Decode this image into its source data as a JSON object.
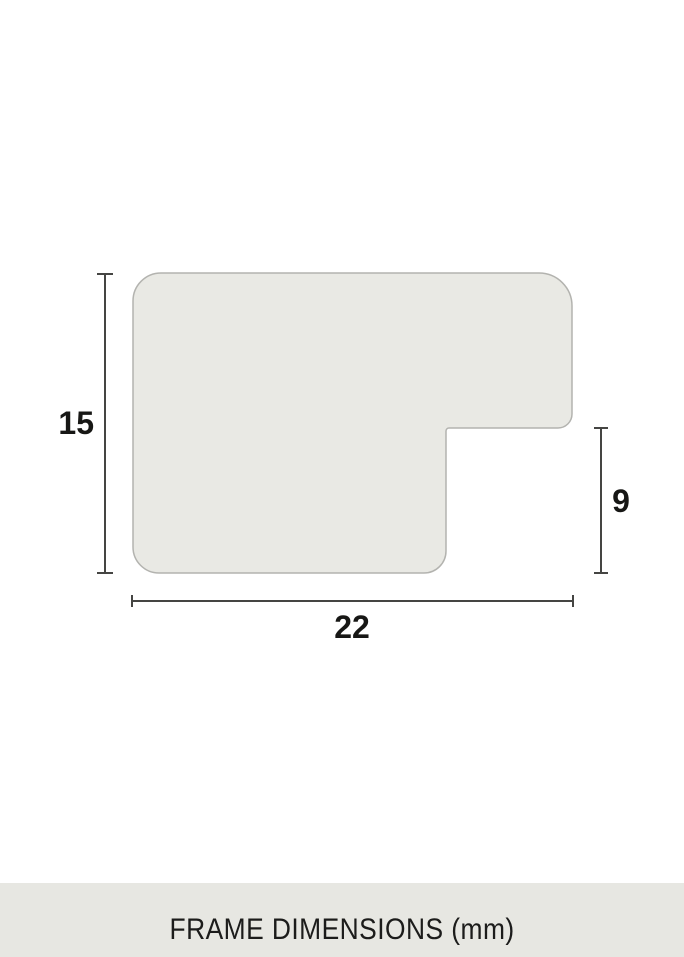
{
  "diagram": {
    "caption": "FRAME DIMENSIONS (mm)",
    "unit": "mm",
    "dimension_left": "15",
    "dimension_right": "9",
    "dimension_bottom": "22"
  },
  "colors": {
    "background": "#ffffff",
    "shape_fill": "#e9e9e4",
    "shape_border": "#b3b3af",
    "dimension_line": "#454543",
    "label_text": "#171715",
    "caption_band": "#e7e7e2",
    "caption_text": "#1c1c1b"
  }
}
